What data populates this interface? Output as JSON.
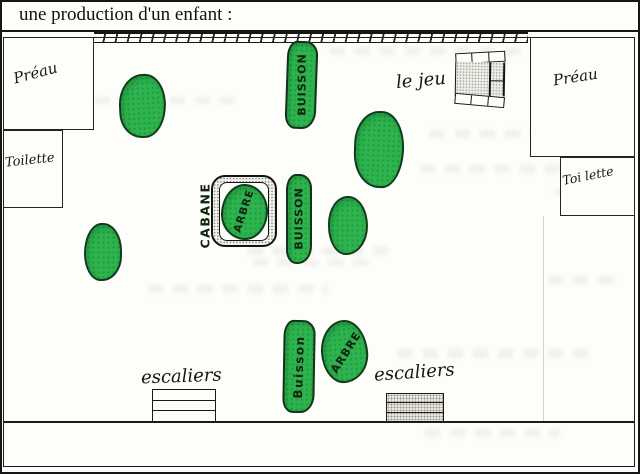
{
  "title": "une production d'un enfant :",
  "map": {
    "preau_left": "Préau",
    "toilette_left": "Toilette",
    "preau_right": "Préau",
    "toilette_right": "Toi lette",
    "le_jeu": "le jeu",
    "cabane": "CABANE",
    "arbre_cabane": "ARBRE",
    "buisson_top": "BUISSON",
    "buisson_mid": "BUISSON",
    "buisson_bottom": "Buisson",
    "arbre_bottom": "ARBRE",
    "escaliers_left": "escaliers",
    "escaliers_right": "escaliers"
  },
  "colors": {
    "vegetation": "#2eb44e",
    "ink": "#1a1a1a"
  }
}
